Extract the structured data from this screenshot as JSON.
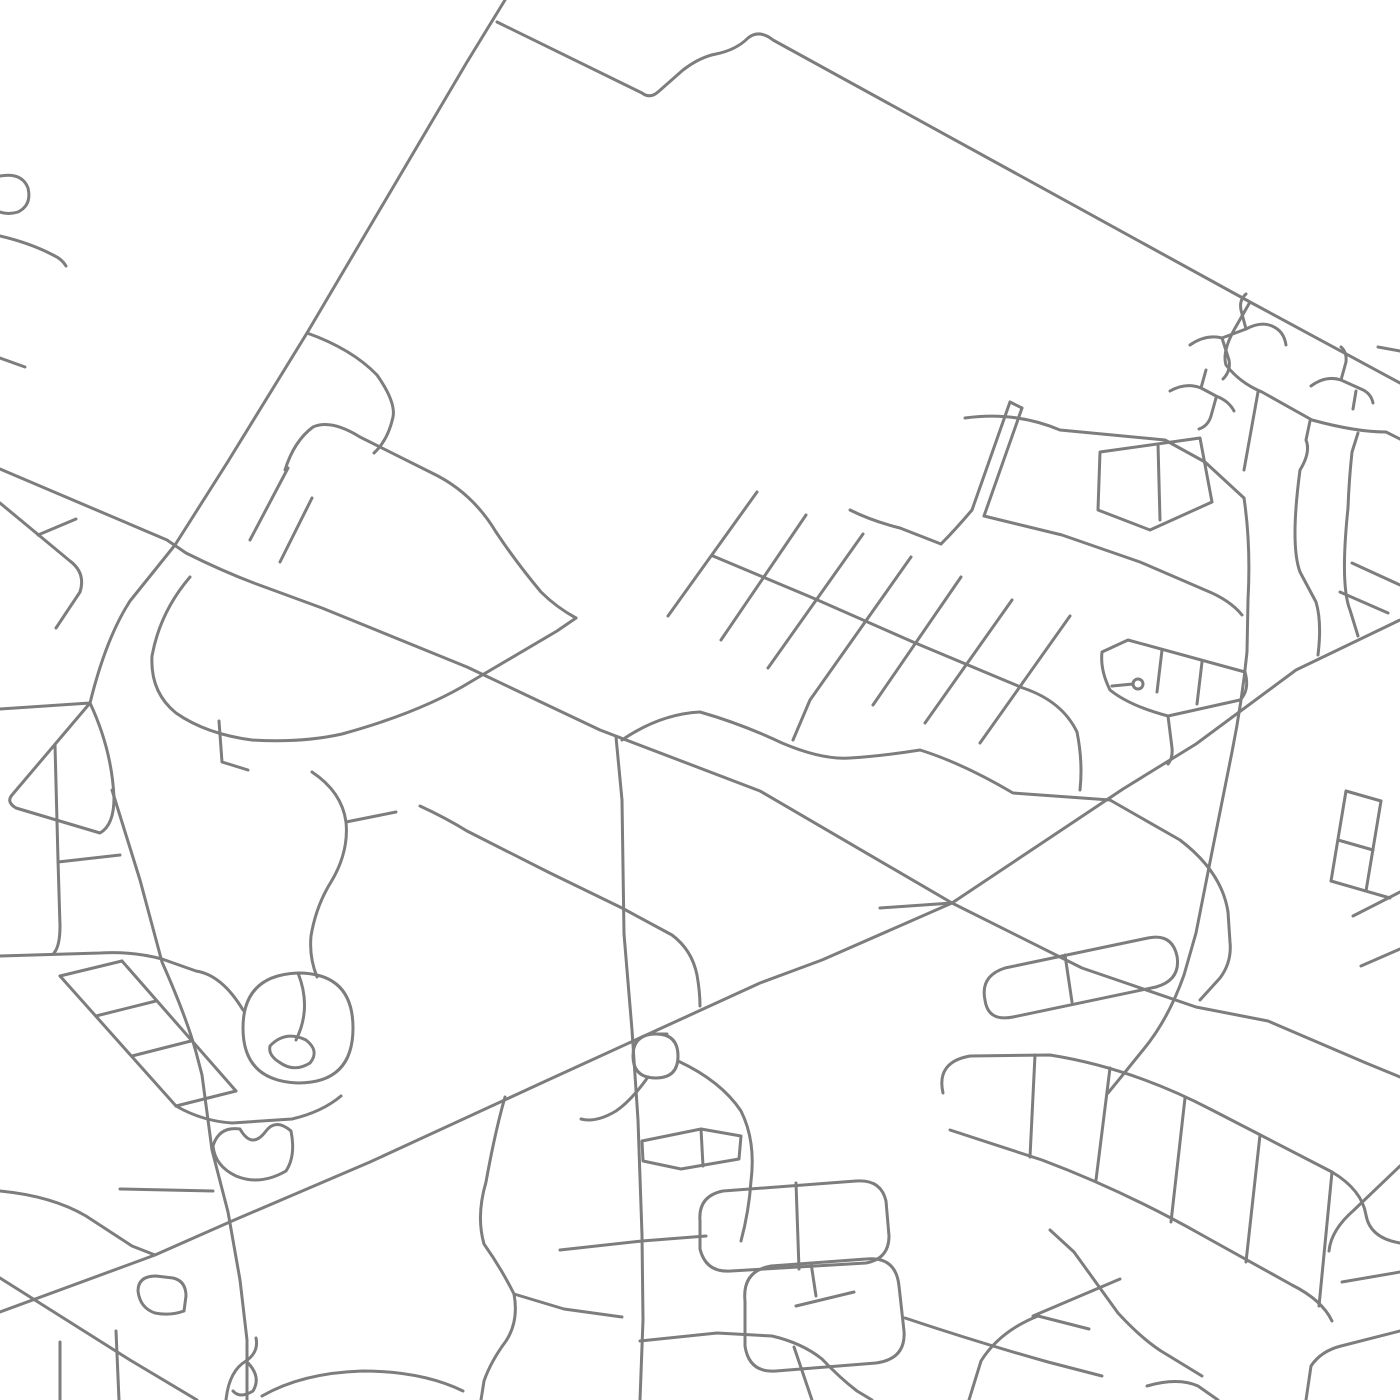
{
  "map": {
    "kind": "street-map",
    "background": "#ffffff",
    "stroke_color": "#7d7d7d",
    "stroke_width": 3,
    "viewbox": "0 0 1400 1400",
    "roads": [
      {
        "name": "arterial-nw-diagonal",
        "d": "M505,0 L467,62 L307,333 L227,463 L175,545 L130,601 Q106,638 90,703"
      },
      {
        "name": "arterial-nw-west-arm",
        "d": "M90,703 L0,709"
      },
      {
        "name": "triangle-loop-west",
        "d": "M90,703 L12,795 Q6,802 16,808 L100,833 Q114,825 114,798 Q112,750 90,703 Z"
      },
      {
        "name": "road-d-south",
        "d": "M112,790 L140,880 L162,962 Q186,1016 196,1052 L202,1075 L212,1150 L228,1212 L240,1280 L247,1340 L247,1400"
      },
      {
        "name": "arterial-e-west-east",
        "d": "M0,469 L167,540 L186,553 Q226,573 262,586 L322,608 L467,667 L600,730 L760,791 L952,903 L1082,968 L1196,1007 L1268,1021 L1366,1063 L1400,1077"
      },
      {
        "name": "arterial-g-sw-ne",
        "d": "M1400,620 L1296,670 L1196,744 L1123,789 L952,903 L822,960 L760,983 L548,1080 L370,1162 L232,1221 L155,1255 L0,1312"
      },
      {
        "name": "arterial-b-top",
        "d": "M497,22 L642,93 Q650,99 658,92 L683,70 Q700,57 716,54 Q736,50 748,38 Q759,29 773,40 L1250,302 L1400,383"
      },
      {
        "name": "road-b-inner-boundary",
        "d": "M1250,302 L1234,330 Q1222,352 1226,365 Q1240,383 1262,392 L1312,420 Q1356,432 1386,432 L1400,439"
      },
      {
        "name": "road-e2-wavy",
        "d": "M622,740 Q660,714 700,712 Q742,724 782,743 Q822,760 850,758 Q882,756 920,750 Q962,763 1013,793 L1110,800 L1180,840 Q1222,872 1228,912 L1230,942 Q1232,962 1220,978 L1200,1000"
      },
      {
        "name": "road-i-vertical",
        "d": "M616,737 L622,800 L624,934 L632,1030 L638,1120 L642,1235 L643,1320 L640,1400"
      },
      {
        "name": "road-h-corner",
        "d": "M0,1278 L130,1360 L197,1400"
      },
      {
        "name": "road-j-vertical",
        "d": "M1244,498 Q1251,545 1248,600 L1247,652 Q1242,702 1232,752 L1212,852 L1196,933 L1184,975 Q1168,1020 1143,1050 Q1122,1076 1108,1093"
      },
      {
        "name": "edge-hook-nw-1",
        "d": "M0,176 Q22,172 28,188 Q32,205 18,212 Q8,215 0,212"
      },
      {
        "name": "edge-hook-nw-2",
        "d": "M0,236 Q30,243 53,255 Q62,259 66,266"
      },
      {
        "name": "edge-stub-nw",
        "d": "M0,358 L25,367"
      },
      {
        "name": "hook-branch",
        "d": "M307,333 Q352,349 377,375 Q396,402 393,417 Q388,440 374,453"
      },
      {
        "name": "sweep-curve",
        "d": "M285,470 Q294,441 313,427 Q331,419 360,437 L432,473 Q472,492 496,532 Q516,562 541,592 Q556,607 576,618"
      },
      {
        "name": "u-curve",
        "d": "M190,577 Q160,612 152,656 Q150,692 176,713 Q206,734 252,740 Q302,743 342,734 Q422,712 472,681 Q525,650 557,631 L576,618"
      },
      {
        "name": "l-stub",
        "d": "M219,721 L222,762 L248,770"
      },
      {
        "name": "row-dash-1",
        "d": "M250,540 L288,468"
      },
      {
        "name": "row-dash-2",
        "d": "M280,562 L312,498"
      },
      {
        "name": "parallel-street-w",
        "d": "M0,503 L70,561 Q86,573 80,592 L56,628"
      },
      {
        "name": "parallel-rung-w",
        "d": "M38,535 L76,519"
      },
      {
        "name": "comb-tooth-1",
        "d": "M757,492 L668,616"
      },
      {
        "name": "comb-tooth-2",
        "d": "M806,515 L721,640"
      },
      {
        "name": "comb-tooth-3",
        "d": "M863,534 L768,668"
      },
      {
        "name": "comb-tooth-4",
        "d": "M911,557 L810,700 Q799,726 793,740"
      },
      {
        "name": "comb-tooth-5",
        "d": "M961,577 L873,705"
      },
      {
        "name": "comb-tooth-6",
        "d": "M1012,600 L925,723"
      },
      {
        "name": "comb-tooth-7",
        "d": "M1070,616 L980,743"
      },
      {
        "name": "comb-spine",
        "d": "M713,556 L813,598 L913,642 L1023,688 Q1062,701 1077,732 Q1083,762 1080,790"
      },
      {
        "name": "comb-connector",
        "d": "M850,510 Q872,521 900,528 L941,544"
      },
      {
        "name": "divided-road-1",
        "d": "M1010,402 L972,510"
      },
      {
        "name": "divided-road-2",
        "d": "M1022,408 L984,516"
      },
      {
        "name": "divided-road-cap",
        "d": "M1010,402 L1022,408"
      },
      {
        "name": "divided-road-tail",
        "d": "M972,510 Q955,530 941,544"
      },
      {
        "name": "wavy-w1",
        "d": "M965,418 Q1015,411 1060,430 L1165,440 L1205,462 L1244,498"
      },
      {
        "name": "connector-b-inner",
        "d": "M1258,392 L1244,470"
      },
      {
        "name": "blocky-rect",
        "d": "M1100,452 L1200,438 L1212,502 L1150,530 L1098,510 Z"
      },
      {
        "name": "blocky-rung",
        "d": "M1158,444 L1160,520"
      },
      {
        "name": "lower-diagonal-mesh",
        "d": "M984,516 L1062,535 L1140,562 L1205,590 Q1230,600 1242,615"
      },
      {
        "name": "zigzag-1",
        "d": "M1310,421 L1306,440 Q1311,452 1300,470 Q1290,545 1300,572 L1316,602 Q1322,622 1318,655"
      },
      {
        "name": "zigzag-2",
        "d": "M1358,433 L1352,452 Q1349,480 1348,508 Q1340,585 1350,610 L1358,636"
      },
      {
        "name": "kite-loop",
        "d": "M1102,652 L1128,640 L1245,672 Q1250,690 1240,700 L1168,716 Q1130,706 1110,690 Q1100,670 1102,652 Z"
      },
      {
        "name": "kite-rung-1",
        "d": "M1162,650 L1157,692"
      },
      {
        "name": "kite-rung-2",
        "d": "M1202,662 L1197,704"
      },
      {
        "name": "kite-roundabout",
        "d": "M1133,684 A5,5 0 1 0 1143,684 A5,5 0 1 0 1133,684"
      },
      {
        "name": "kite-spoke",
        "d": "M1112,686 L1133,684"
      },
      {
        "name": "kite-tail",
        "d": "M1168,716 L1172,748 Q1173,758 1168,764"
      },
      {
        "name": "right-edge-dash-1",
        "d": "M1352,563 L1400,585"
      },
      {
        "name": "right-edge-dash-2",
        "d": "M1340,592 L1388,613"
      },
      {
        "name": "culdesac-1a",
        "d": "M1190,345 Q1206,334 1222,338 L1246,329 Q1261,321 1272,326 Q1284,331 1286,345"
      },
      {
        "name": "culdesac-1b",
        "d": "M1246,329 L1241,310 Q1239,300 1246,294"
      },
      {
        "name": "culdesac-1c",
        "d": "M1222,338 L1229,360 Q1231,371 1223,379"
      },
      {
        "name": "culdesac-2a",
        "d": "M1170,391 Q1186,382 1201,388 L1216,396 Q1229,401 1234,411"
      },
      {
        "name": "culdesac-2b",
        "d": "M1201,388 L1206,370"
      },
      {
        "name": "culdesac-2c",
        "d": "M1216,398 L1211,416 Q1208,426 1199,429"
      },
      {
        "name": "culdesac-3a",
        "d": "M1311,386 Q1326,375 1341,380 L1361,389 Q1371,393 1373,403"
      },
      {
        "name": "culdesac-3b",
        "d": "M1341,380 L1346,362 Q1347,352 1341,347"
      },
      {
        "name": "culdesac-3c",
        "d": "M1356,391 L1353,409"
      },
      {
        "name": "edge-stub-ne",
        "d": "M1378,347 L1400,351"
      },
      {
        "name": "left-nbhd-vertical",
        "d": "M55,745 L58,860 L60,926 Q60,946 54,953"
      },
      {
        "name": "left-nbhd-branch",
        "d": "M58,862 L120,855"
      },
      {
        "name": "left-nbhd-horizontal",
        "d": "M0,956 L100,953 Q132,951 162,959 L196,971"
      },
      {
        "name": "ladder-rail-1",
        "d": "M60,976 L176,1106"
      },
      {
        "name": "ladder-rail-2",
        "d": "M122,961 L236,1091"
      },
      {
        "name": "ladder-rung-1",
        "d": "M60,976 L122,961"
      },
      {
        "name": "ladder-rung-2",
        "d": "M96,1016 L156,1001"
      },
      {
        "name": "ladder-rung-3",
        "d": "M132,1056 L191,1041"
      },
      {
        "name": "ladder-rung-4",
        "d": "M176,1106 L236,1091"
      },
      {
        "name": "oval-loop",
        "d": "M243,1028 Q243,975 298,973 Q353,973 353,1028 Q353,1083 298,1083 Q243,1081 243,1028 Z"
      },
      {
        "name": "oval-inner-loop",
        "d": "M270,1046 Q285,1030 306,1040 Q320,1051 310,1063 Q294,1073 279,1062 Q268,1055 270,1046 Z"
      },
      {
        "name": "oval-inner-arc",
        "d": "M298,973 Q312,1008 296,1040"
      },
      {
        "name": "oval-connector",
        "d": "M196,971 Q222,975 243,1010"
      },
      {
        "name": "s-road-left",
        "d": "M312,772 Q342,792 346,822 Q349,852 331,882 Q316,906 311,936 Q309,957 317,977"
      },
      {
        "name": "s-road-branch",
        "d": "M346,822 L396,812"
      },
      {
        "name": "below-oval-road",
        "d": "M176,1106 Q202,1121 232,1123 L292,1119 Q322,1112 341,1096"
      },
      {
        "name": "mitten-loop",
        "d": "M213,1146 Q219,1126 240,1129 Q252,1150 266,1131 Q276,1118 291,1131 Q296,1156 286,1171 Q260,1186 236,1176 Q215,1166 213,1146 Z"
      },
      {
        "name": "mitten-feeder",
        "d": "M120,1189 L213,1191"
      },
      {
        "name": "bl-feeder",
        "d": "M0,1191 Q52,1196 86,1216 L132,1246 L155,1255"
      },
      {
        "name": "bl-square-hook",
        "d": "M138,1291 Q138,1276 156,1276 L173,1278 Q186,1281 186,1296 L184,1311 Q170,1316 155,1313 Q140,1308 138,1291 Z"
      },
      {
        "name": "bl-vertical-1",
        "d": "M116,1331 L119,1400"
      },
      {
        "name": "bl-vertical-2",
        "d": "M60,1342 L60,1400"
      },
      {
        "name": "bl-wiggle",
        "d": "M226,1400 Q229,1371 246,1361 Q259,1352 256,1338"
      },
      {
        "name": "bl-bulb",
        "d": "M246,1361 Q262,1376 253,1391 Q240,1399 233,1391"
      },
      {
        "name": "s1-curvy",
        "d": "M505,1097 Q495,1132 486,1182 Q476,1216 484,1244 Q501,1268 514,1294 Q519,1321 506,1341 Q491,1361 484,1381 L481,1400"
      },
      {
        "name": "s1-branch",
        "d": "M514,1294 L564,1309 L622,1317"
      },
      {
        "name": "cross-street-1240",
        "d": "M560,1250 L642,1241 L706,1236"
      },
      {
        "name": "cross-street-1335",
        "d": "M640,1341 L717,1333 L772,1336 Q802,1343 822,1359 Q840,1378 857,1391 L872,1400"
      },
      {
        "name": "branch-to-bottom",
        "d": "M794,1347 L812,1400"
      },
      {
        "name": "bottom-wavy",
        "d": "M262,1396 Q302,1373 362,1371 Q422,1371 463,1391"
      },
      {
        "name": "flower-loop",
        "d": "M633,1056 Q633,1034 656,1034 Q678,1034 656,1034 Q633,1034 633,1056 Q633,1078 656,1078 Q678,1078 678,1056 Q678,1034 656,1034"
      },
      {
        "name": "flower-tail",
        "d": "M648,1077 Q631,1101 616,1111 Q596,1123 581,1119"
      },
      {
        "name": "flower-rects",
        "d": "M642,1141 L701,1129 L741,1136 L739,1159 L681,1169 L643,1161 Z"
      },
      {
        "name": "flower-rung",
        "d": "M701,1129 L703,1166"
      },
      {
        "name": "flower-arm",
        "d": "M678,1061 Q721,1081 741,1111 Q756,1141 751,1181 Q749,1211 741,1241"
      },
      {
        "name": "pill-loop-1",
        "d": "M700,1221 Q698,1196 723,1191 L856,1181 Q881,1179 886,1201 L889,1236 Q889,1259 866,1263 L731,1271 Q706,1273 700,1249 Z"
      },
      {
        "name": "pill-1-rung",
        "d": "M796,1183 L799,1269"
      },
      {
        "name": "pill-loop-2",
        "d": "M745,1301 Q742,1271 771,1266 L866,1259 Q896,1256 899,1286 L904,1331 Q906,1359 876,1363 L776,1371 Q749,1373 745,1346 Z"
      },
      {
        "name": "pill-2-rung",
        "d": "M811,1263 L816,1296"
      },
      {
        "name": "pill-2-inner",
        "d": "M796,1306 L854,1292"
      },
      {
        "name": "pill-loop-3",
        "d": "M985,1000 Q980,976 1005,968 L1148,938 Q1172,933 1177,956 Q1181,980 1156,987 L1013,1017 Q988,1022 985,1000 Z"
      },
      {
        "name": "pill-3-rung",
        "d": "M1065,955 L1072,1002"
      },
      {
        "name": "ladder-se-rail-1",
        "d": "M943,1093 Q936,1062 970,1056 L1050,1055 Q1132,1068 1212,1110 L1332,1172 Q1362,1190 1366,1215 Q1370,1238 1400,1243"
      },
      {
        "name": "ladder-se-rail-2",
        "d": "M950,1130 L1042,1160 Q1122,1190 1202,1235 L1292,1285 Q1322,1300 1332,1321"
      },
      {
        "name": "ladder-se-rail-3",
        "d": "M1050,1230 L1074,1252 L1118,1313 Q1141,1338 1161,1351 L1202,1376"
      },
      {
        "name": "ladder-se-rung-1",
        "d": "M1035,1055 L1030,1157"
      },
      {
        "name": "ladder-se-rung-2",
        "d": "M1110,1068 L1096,1180"
      },
      {
        "name": "ladder-se-rung-3",
        "d": "M1185,1098 L1171,1222"
      },
      {
        "name": "ladder-se-rung-4",
        "d": "M1260,1135 L1246,1262"
      },
      {
        "name": "ladder-se-rung-5",
        "d": "M1332,1172 L1319,1306"
      },
      {
        "name": "ladder-se-endcurve",
        "d": "M1038,1316 Q1000,1331 981,1361 L969,1400"
      },
      {
        "name": "ladder-se-stub",
        "d": "M1038,1316 L1089,1329"
      },
      {
        "name": "bottom-road-se",
        "d": "M905,1318 Q980,1343 1048,1362 L1102,1376"
      },
      {
        "name": "diag-connector-se",
        "d": "M1033,1316 L1120,1279"
      },
      {
        "name": "right-edge-road-1",
        "d": "M1400,1166 L1354,1210 Q1331,1230 1329,1251"
      },
      {
        "name": "right-edge-road-2",
        "d": "M1400,1272 L1342,1282"
      },
      {
        "name": "corner-curve-se",
        "d": "M1147,1386 Q1178,1377 1198,1386 L1218,1400"
      },
      {
        "name": "corner-road-se",
        "d": "M1400,1331 L1341,1346 Q1321,1351 1311,1366 L1306,1400"
      },
      {
        "name": "right-edge-dash-3",
        "d": "M1400,892 L1353,916"
      },
      {
        "name": "right-edge-dash-4",
        "d": "M1400,949 L1361,966"
      },
      {
        "name": "re-grid-rail-1",
        "d": "M1346,791 L1331,881"
      },
      {
        "name": "re-grid-rail-2",
        "d": "M1381,801 L1366,891"
      },
      {
        "name": "re-grid-rung-1",
        "d": "M1346,791 L1381,801"
      },
      {
        "name": "re-grid-rung-2",
        "d": "M1338,840 L1373,850"
      },
      {
        "name": "re-grid-tail",
        "d": "M1331,881 L1390,898"
      },
      {
        "name": "road-h2",
        "d": "M420,806 Q446,818 467,831 L548,872 L622,908 L672,935 Q692,950 697,975 Q700,992 700,1006"
      },
      {
        "name": "x-spur",
        "d": "M952,903 L880,908"
      }
    ]
  }
}
